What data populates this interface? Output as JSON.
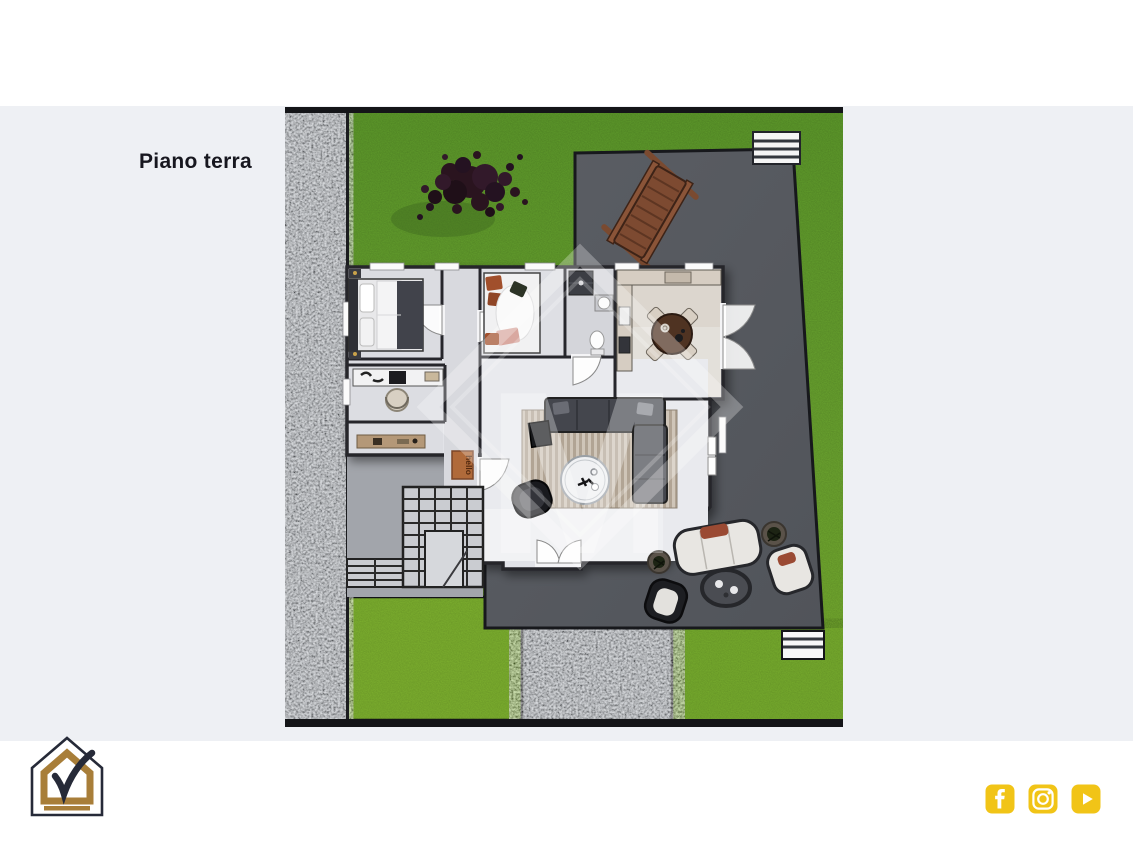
{
  "slide": {
    "title": "Piano terra"
  },
  "plan": {
    "watermark_letter": "M",
    "doormat_text": "hello",
    "features": [
      "garden",
      "stone-path",
      "terrace",
      "tree",
      "sun-lounger",
      "bedroom-1",
      "bedroom-2",
      "study",
      "bathroom",
      "kitchen-dining",
      "living-room",
      "external-staircase",
      "outdoor-lounge-set",
      "entry-steps"
    ]
  },
  "footer": {
    "logo": "house-checkmark-logo",
    "social": [
      {
        "name": "facebook"
      },
      {
        "name": "instagram"
      },
      {
        "name": "youtube"
      }
    ]
  },
  "colors": {
    "background": "#eef0f4",
    "band_white": "#ffffff",
    "title_text": "#17171f",
    "accent_yellow": "#f1c417",
    "logo_gold": "#a87e39",
    "logo_outline": "#262a38",
    "grass": "#6ca630",
    "grass_bright": "#7cb232",
    "stone": "#a6abb2",
    "terrace": "#56595f",
    "wall": "#26262b"
  }
}
